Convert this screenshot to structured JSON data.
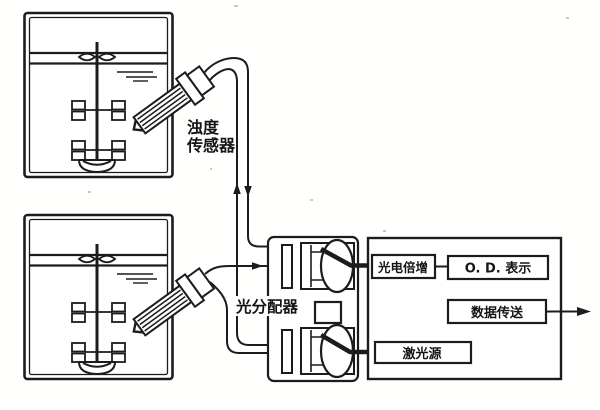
{
  "diagram": {
    "labels": {
      "turbidity_sensor": {
        "line1": "浊度",
        "line2": "传感器"
      },
      "light_distributor": "光分配器",
      "photomultiplier": "光电倍增",
      "od_display": "O. D. 表示",
      "data_transfer": "数据传送",
      "laser_source": "激光源"
    },
    "colors": {
      "ink": "#1c1c1c",
      "background": "#ffffff"
    }
  }
}
